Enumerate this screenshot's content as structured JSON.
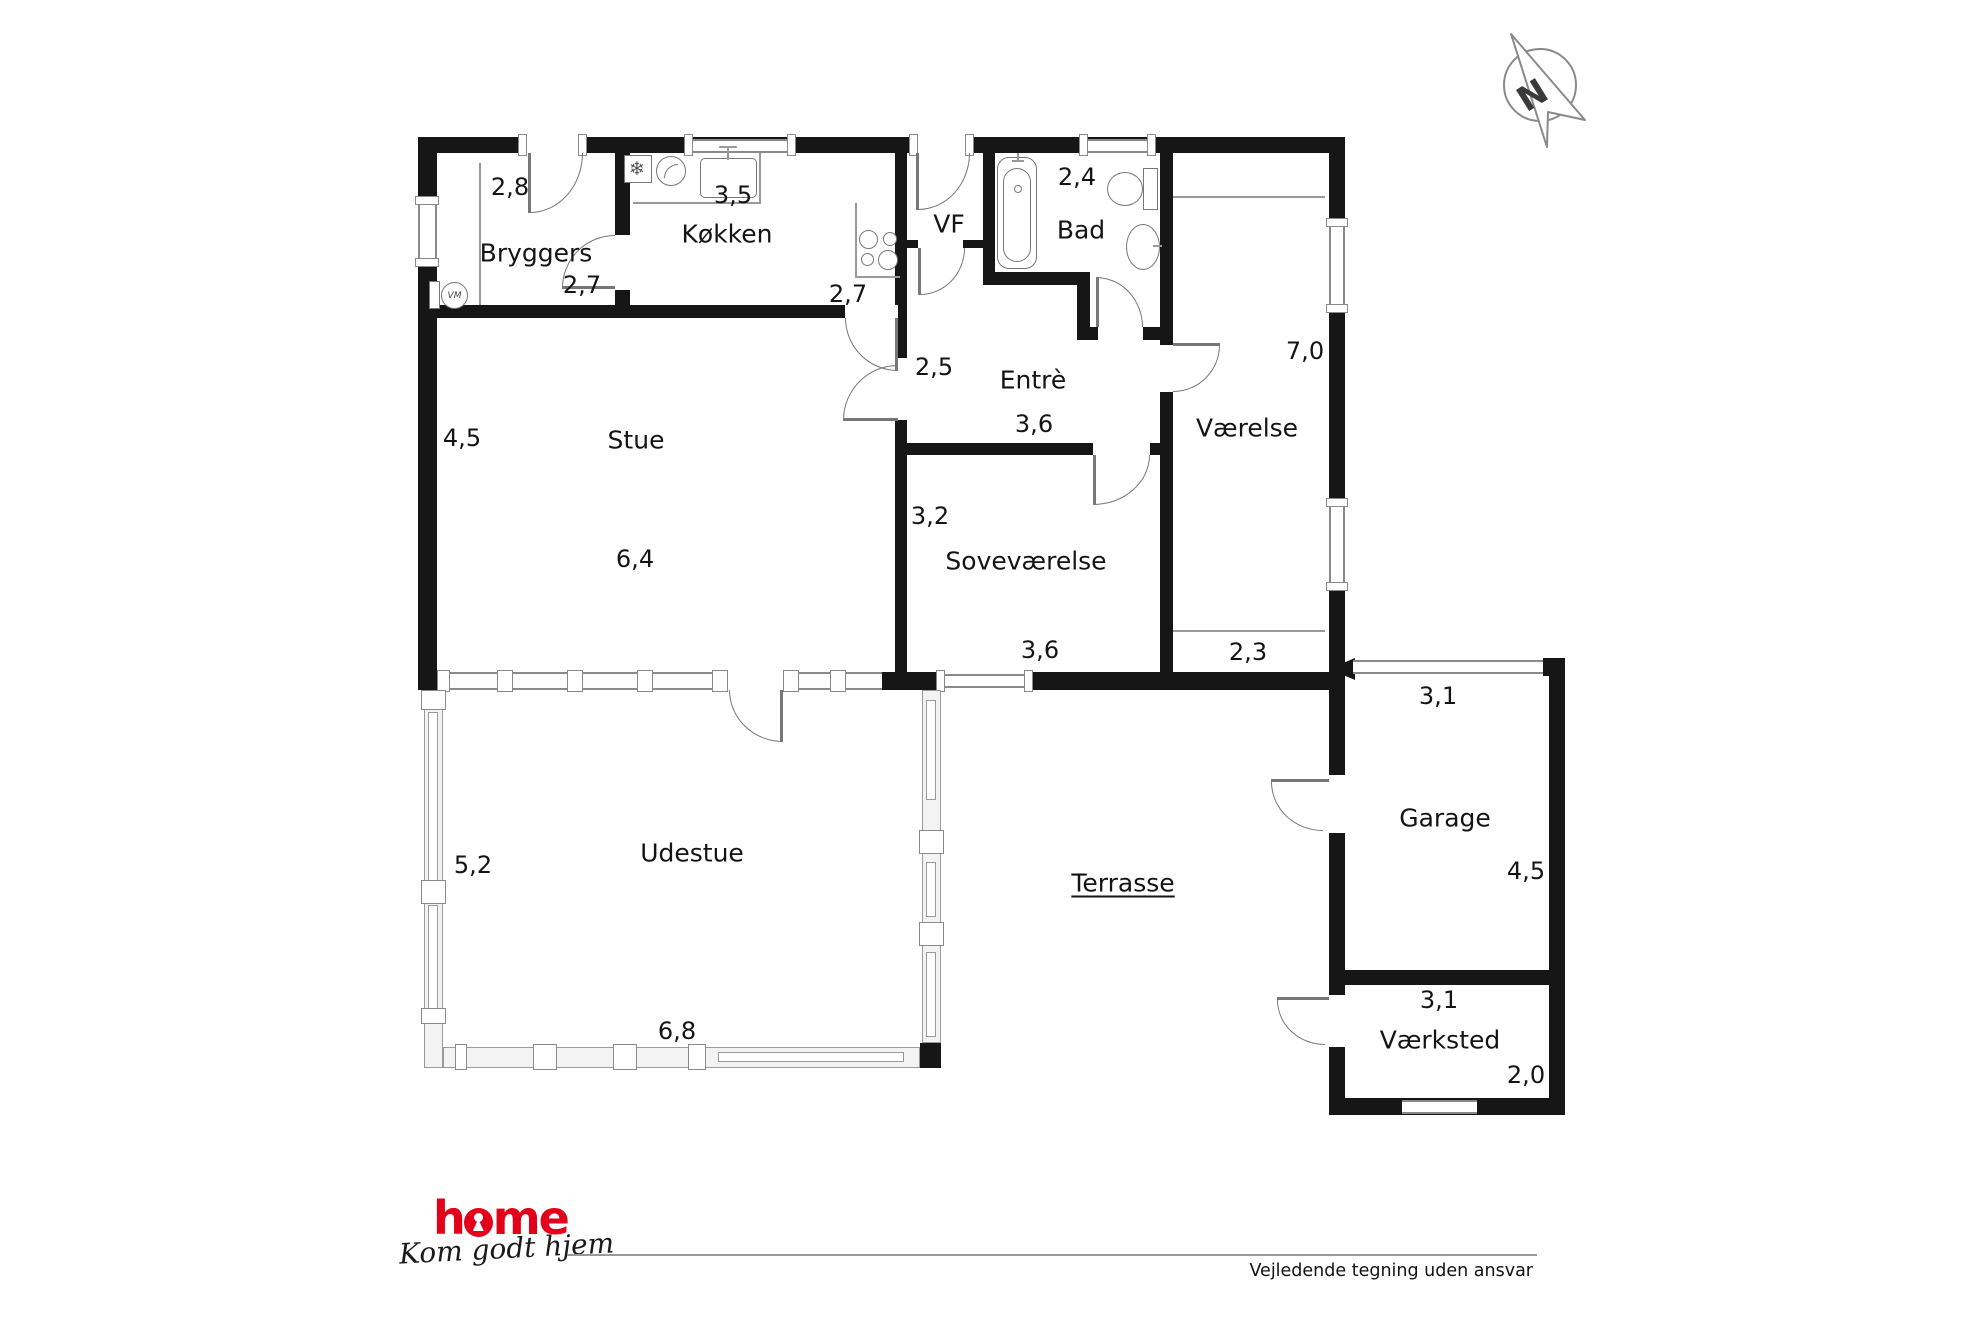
{
  "plan": {
    "compass": {
      "letter": "N"
    },
    "rooms": {
      "bryggers": {
        "label": "Bryggers",
        "width": "2,8",
        "depth": "2,7"
      },
      "kokken": {
        "label": "Køkken",
        "width": "3,5",
        "depth": "2,7"
      },
      "vf": {
        "label": "VF"
      },
      "bad": {
        "label": "Bad",
        "width": "2,4"
      },
      "vaerelse": {
        "label": "Værelse",
        "length": "7,0",
        "niche_width": "2,3"
      },
      "entre": {
        "label": "Entrè",
        "width": "2,5",
        "length": "3,6"
      },
      "stue": {
        "label": "Stue",
        "depth": "4,5",
        "width": "6,4"
      },
      "sovevaerelse": {
        "label": "Soveværelse",
        "depth": "3,2",
        "width": "3,6"
      },
      "udestue": {
        "label": "Udestue",
        "depth": "5,2",
        "width": "6,8"
      },
      "terrasse": {
        "label": "Terrasse"
      },
      "garage": {
        "label": "Garage",
        "width": "3,1",
        "depth": "4,5"
      },
      "vaerksted": {
        "label": "Værksted",
        "width": "3,1",
        "depth": "2,0"
      }
    },
    "fixtures": {
      "washing_machine": "VM"
    }
  },
  "footer": {
    "brand": "home",
    "brand_prefix": "h",
    "brand_suffix": "me",
    "tagline": "Kom godt hjem",
    "disclaimer": "Vejledende tegning uden ansvar"
  },
  "colors": {
    "wall": "#161616",
    "brand_red": "#e2001a",
    "line_gray": "#8a8a8a"
  }
}
